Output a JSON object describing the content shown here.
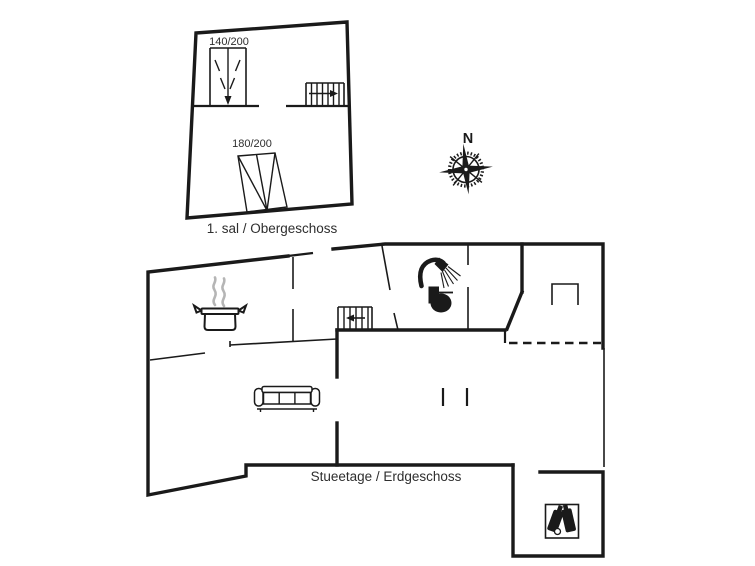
{
  "colors": {
    "background": "#ffffff",
    "line": "#1a1a1a",
    "steam": "#b5b5b5",
    "text": "#2e2e2e"
  },
  "compass": {
    "label": "N",
    "icon": "compass-rose-icon"
  },
  "upper_floor": {
    "label": "1. sal / Obergeschoss",
    "bed_small": {
      "label": "140/200",
      "icon": "double-bed-icon"
    },
    "bed_large": {
      "label": "180/200",
      "icon": "double-bed-icon"
    },
    "stairs": {
      "icon": "staircase-icon",
      "direction": "right"
    }
  },
  "ground_floor": {
    "label": "Stueetage / Erdgeschoss",
    "stairs": {
      "icon": "staircase-icon",
      "direction": "left"
    },
    "kitchen": {
      "icon": "cooking-pot-icon"
    },
    "bathroom": {
      "icons": [
        "shower-icon",
        "toilet-icon"
      ]
    },
    "living_room": {
      "icon": "sofa-icon"
    },
    "annex": {
      "icon": "wine-bottles-icon"
    },
    "fireplace": {
      "icon": "fireplace-icon"
    },
    "terrace": {
      "boundary": "dashed-open-side"
    }
  }
}
